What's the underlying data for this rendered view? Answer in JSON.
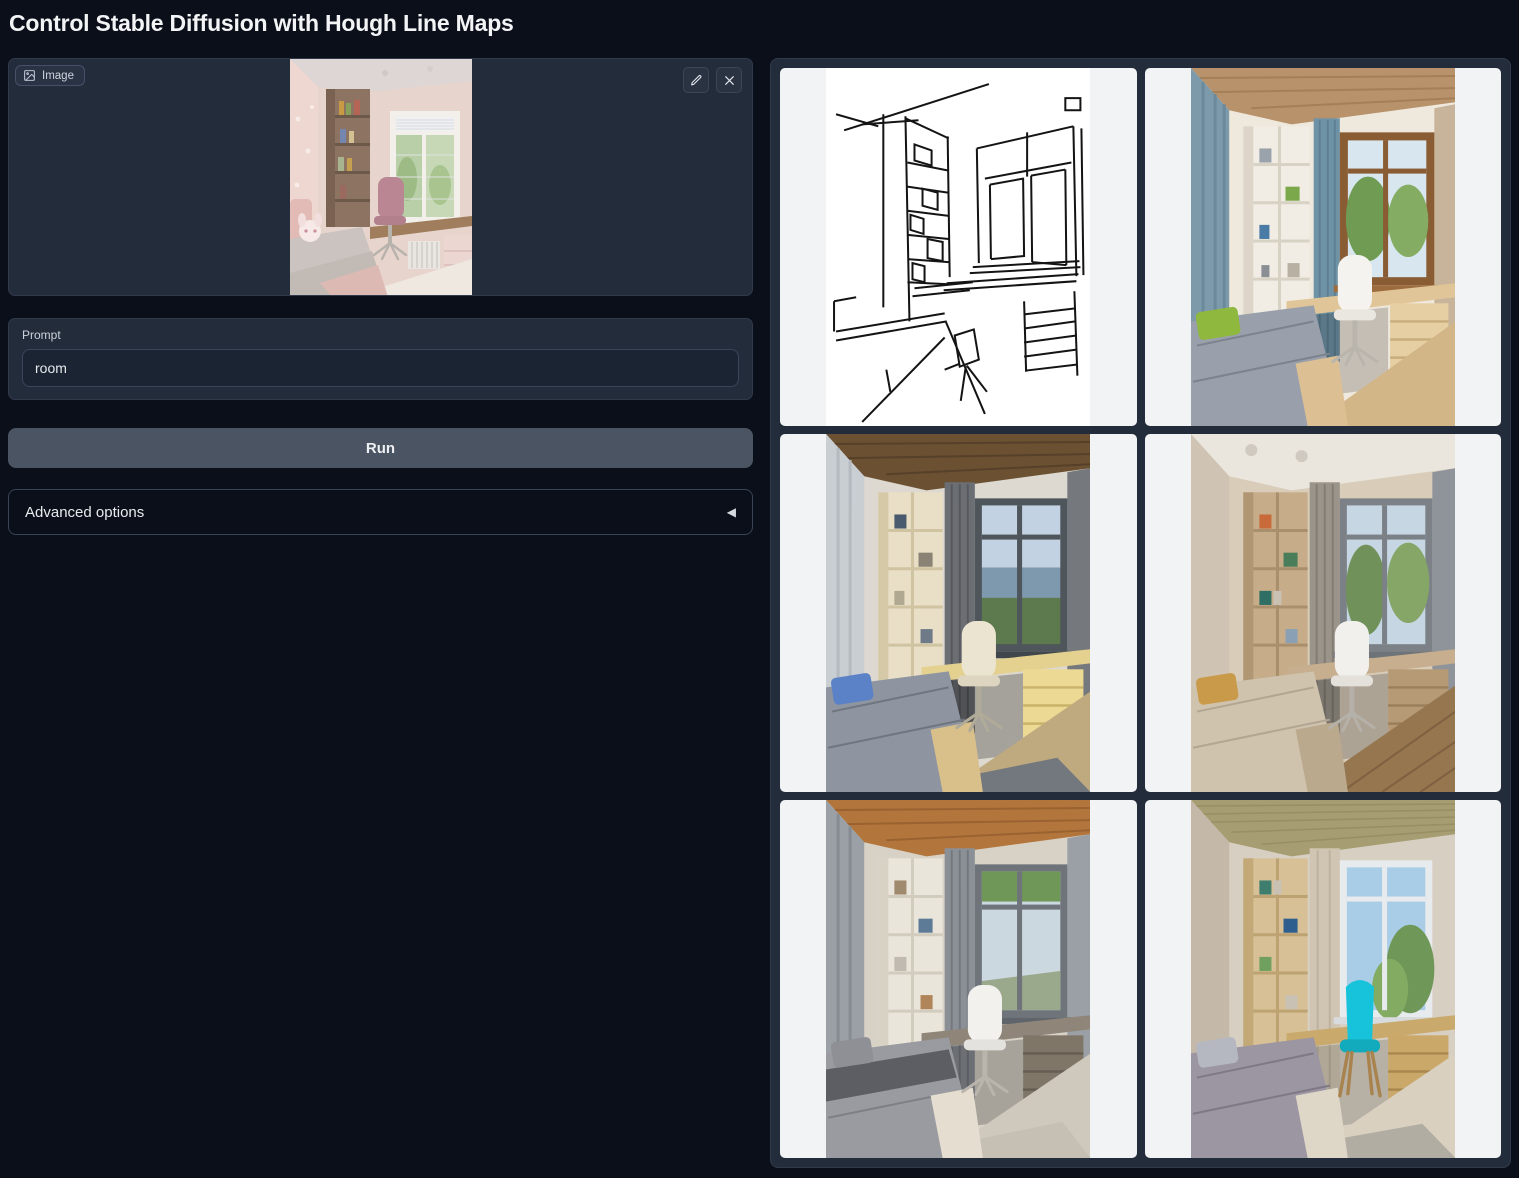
{
  "page": {
    "title": "Control Stable Diffusion with Hough Line Maps"
  },
  "image_input": {
    "label": "Image",
    "alt": "Photo of a child's bedroom in pink tones with a wooden bookshelf, window, desk with pink chair and a bed with a plush toy"
  },
  "prompt": {
    "label": "Prompt",
    "value": "room"
  },
  "run_button": {
    "label": "Run"
  },
  "advanced": {
    "label": "Advanced options"
  },
  "icons": {
    "image_label_icon": "picture-frame",
    "edit_icon": "pencil",
    "clear_icon": "x-cross",
    "accordion_arrow": "◀"
  },
  "gallery": {
    "items": [
      {
        "name": "hough-line-map",
        "description": "Hough line map: black straight-line sketch of the room on white"
      },
      {
        "name": "generated-room-1",
        "description": "Generated room with wood ceiling, blue curtains, white shelf, green pillow, grey bed and white chair"
      },
      {
        "name": "generated-room-2",
        "description": "Generated room with dark wood ceiling, grey curtains, cream shelving, yellow desk drawers, blue pillow and cream chair"
      },
      {
        "name": "generated-room-3",
        "description": "Generated beige room with wooden shelf, white chair, mustard pillow and wooden floor"
      },
      {
        "name": "generated-room-4",
        "description": "Generated room with orange wood ceiling, grey curtains, white chair and grey patterned bed"
      },
      {
        "name": "generated-room-5",
        "description": "Generated room with olive ceiling, wooden shelf and desk, cyan chair and grey bed"
      }
    ]
  },
  "colors": {
    "background": "#0b0f19",
    "panel": "#232c3b",
    "border": "#3a4456",
    "run_button": "#4a5462",
    "gallery_cell": "#f2f3f5",
    "accent_cyan_chair": "#17c3da"
  }
}
